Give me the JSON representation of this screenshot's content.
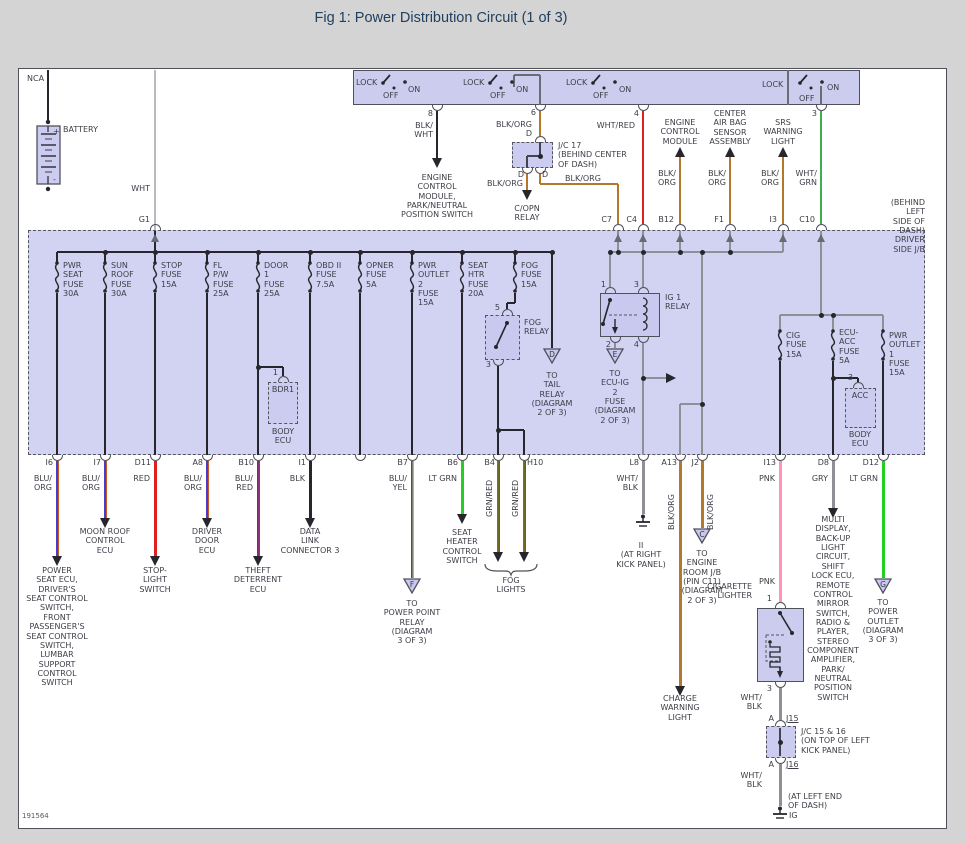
{
  "title": "Fig 1: Power Distribution Circuit (1 of 3)",
  "doc_number": "191564",
  "colors": {
    "panel_fill": "#cdcdf1",
    "box_fill": "#ccccee",
    "relay_fill": "#c9c9f0",
    "wire_blk_org": "#b4782a",
    "wire_red": "#e02020",
    "wire_wht_grn": "#3cae54",
    "wire_lt_grn": "#22cf22",
    "wire_pnk": "#ff93b8",
    "wire_gry": "#8f8f96",
    "wire_blu_org": "#4b3bc8",
    "title_color": "#21405f"
  },
  "battery": {
    "nca": "NCA",
    "label": "BATTERY",
    "plus": "+",
    "minus": "-",
    "wire": "WHT",
    "connector": "G1"
  },
  "ignition": {
    "lock": "LOCK",
    "off": "OFF",
    "on": "ON"
  },
  "jb": {
    "caption": "(BEHIND LEFT\nSIDE OF DASH)\nDRIVER SIDE J/B"
  },
  "top": {
    "ecm": {
      "pin": "8",
      "wire": "BLK/\nWHT",
      "dest": "ENGINE\nCONTROL\nMODULE,\nPARK/NEUTRAL\nPOSITION SWITCH"
    },
    "jc17": {
      "pin": "6",
      "wire": "BLK/ORG",
      "pin_d": "D",
      "label": "J/C 17\n(BEHIND CENTER\nOF DASH)",
      "out_left_pin": "D",
      "out_right_pin": "D",
      "wire_left": "BLK/ORG",
      "dest_left": "C/OPN\nRELAY",
      "wire_right": "BLK/ORG",
      "connector": "C7"
    },
    "ig2": {
      "pin": "4",
      "wire": "WHT/RED",
      "connector": "C4"
    },
    "ecm2": {
      "dest": "ENGINE\nCONTROL\nMODULE",
      "wire": "BLK/\nORG",
      "connector": "B12"
    },
    "airbag": {
      "dest": "CENTER\nAIR BAG\nSENSOR\nASSEMBLY",
      "wire": "BLK/\nORG",
      "connector": "F1"
    },
    "srs": {
      "dest": "SRS\nWARNING\nLIGHT",
      "wire": "BLK/\nORG",
      "connector": "I3"
    },
    "acc_feed": {
      "pin": "3",
      "wire": "WHT/\nGRN",
      "connector": "C10"
    }
  },
  "fuses": {
    "pwr_seat": "PWR\nSEAT\nFUSE\n30A",
    "sun_roof": "SUN\nROOF\nFUSE\n30A",
    "stop": "STOP\nFUSE\n15A",
    "fl_pw": "FL\nP/W\nFUSE\n25A",
    "door1": "DOOR\n1\nFUSE\n25A",
    "obd2": "OBD II\nFUSE\n7.5A",
    "opner": "OPNER\nFUSE\n5A",
    "pwr_outlet2": "PWR\nOUTLET\n2\nFUSE\n15A",
    "seat_htr": "SEAT\nHTR\nFUSE\n20A",
    "fog": "FOG\nFUSE\n15A",
    "cig": "CIG\nFUSE\n15A",
    "ecu_acc": "ECU-\nACC\nFUSE\n5A",
    "pwr_outlet1": "PWR\nOUTLET\n1\nFUSE\n15A"
  },
  "relays": {
    "fog": {
      "pin5": "5",
      "label": "FOG\nRELAY",
      "pin3": "3"
    },
    "ig1": {
      "label": "IG 1\nRELAY",
      "pin1": "1",
      "pin2": "2",
      "pin3": "3",
      "pin4": "4"
    }
  },
  "bdr1": {
    "pin": "1",
    "name": "BDR1",
    "sub": "BODY\nECU"
  },
  "acc": {
    "pin": "3",
    "name": "ACC",
    "sub": "BODY\nECU"
  },
  "tri": {
    "d": {
      "letter": "D",
      "dest": "TO\nTAIL\nRELAY\n(DIAGRAM\n2 OF 3)"
    },
    "e": {
      "letter": "E",
      "dest": "TO\nECU-IG\n2\nFUSE\n(DIAGRAM\n2 OF 3)"
    }
  },
  "out": {
    "i6": {
      "id": "I6",
      "wire": "BLU/\nORG",
      "dest": "POWER\nSEAT ECU,\nDRIVER'S\nSEAT CONTROL\nSWITCH,\nFRONT\nPASSENGER'S\nSEAT CONTROL\nSWITCH,\nLUMBAR\nSUPPORT\nCONTROL\nSWITCH"
    },
    "i7": {
      "id": "I7",
      "wire": "BLU/\nORG",
      "dest": "MOON ROOF\nCONTROL\nECU"
    },
    "d11": {
      "id": "D11",
      "wire": "RED",
      "dest": "STOP-\nLIGHT\nSWITCH"
    },
    "a8": {
      "id": "A8",
      "wire": "BLU/\nORG",
      "dest": "DRIVER\nDOOR\nECU"
    },
    "b10": {
      "id": "B10",
      "wire": "BLU/\nRED",
      "dest": "THEFT\nDETERRENT\nECU"
    },
    "i1": {
      "id": "I1",
      "wire": "BLK",
      "dest": "DATA\nLINK\nCONNECTOR 3"
    },
    "b7": {
      "id": "B7",
      "wire": "BLU/\nYEL",
      "tri": "F",
      "dest": "TO\nPOWER POINT\nRELAY\n(DIAGRAM\n3 OF 3)"
    },
    "b6": {
      "id": "B6",
      "wire": "LT GRN",
      "dest": "SEAT\nHEATER\nCONTROL\nSWITCH"
    },
    "b4": {
      "id": "B4",
      "wire": "GRN/RED"
    },
    "h10": {
      "id": "H10",
      "wire": "GRN/RED"
    },
    "fog_lights": "FOG\nLIGHTS",
    "l8": {
      "id": "L8",
      "wire": "WHT/\nBLK",
      "dest": "II\n(AT RIGHT\nKICK PANEL)"
    },
    "a13": {
      "id": "A13",
      "wire": "BLK/ORG",
      "dest": "CHARGE\nWARNING\nLIGHT"
    },
    "j2": {
      "id": "J2",
      "wire": "BLK/ORG",
      "tri": "C",
      "dest": "TO\nENGINE\nROOM J/B\n(PIN C11)\n(DIAGRAM\n2 OF 3)"
    },
    "i13": {
      "id": "I13",
      "wire": "PNK",
      "wire2": "PNK",
      "comp": "CIGARETTE\nLIGHTER",
      "pin1": "1",
      "pin3": "3",
      "wire3": "WHT/\nBLK",
      "a1": "A",
      "j15": "J15",
      "jc": "J/C 15 & 16\n(ON TOP OF LEFT\nKICK PANEL)",
      "a2": "A",
      "j16": "J16",
      "wire4": "WHT/\nBLK",
      "loc": "(AT LEFT END\nOF DASH)",
      "gnd": "IG"
    },
    "d8": {
      "id": "D8",
      "wire": "GRY",
      "dest": "MULTI\nDISPLAY,\nBACK-UP\nLIGHT\nCIRCUIT,\nSHIFT\nLOCK ECU,\nREMOTE\nCONTROL\nMIRROR\nSWITCH,\nRADIO &\nPLAYER,\nSTEREO\nCOMPONENT\nAMPLIFIER,\nPARK/\nNEUTRAL\nPOSITION\nSWITCH"
    },
    "d12": {
      "id": "D12",
      "wire": "LT GRN",
      "tri": "G",
      "dest": "TO\nPOWER\nOUTLET\n(DIAGRAM\n3 OF 3)"
    }
  }
}
